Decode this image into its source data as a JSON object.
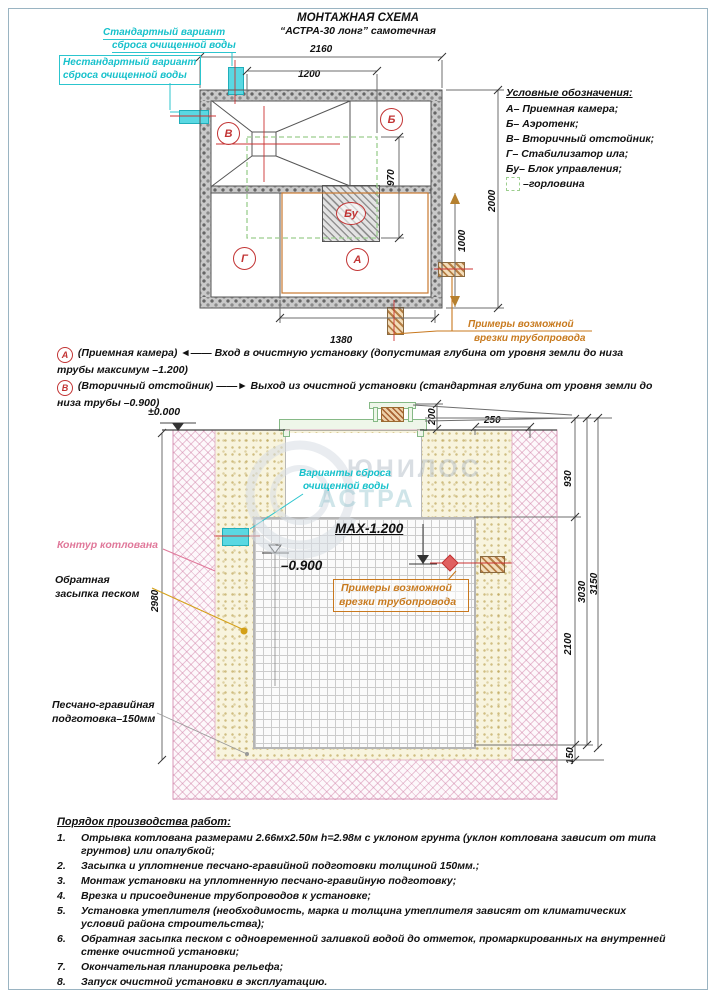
{
  "title": {
    "line1": "МОНТАЖНАЯ СХЕМА",
    "line2": "“АСТРА-30 лонг” самотечная"
  },
  "plan": {
    "standard_outlet": {
      "line1": "Стандартный вариант",
      "line2": "сброса очищенной воды"
    },
    "nonstandard_outlet": {
      "line1": "Нестандартный вариант",
      "line2": "сброса очищенной воды"
    },
    "compartments": {
      "a": "А",
      "b": "Б",
      "v": "В",
      "g": "Г",
      "bu": "Бу"
    },
    "dims": {
      "total_width": "2160",
      "neck_width": "1200",
      "neck_height": "970",
      "total_height": "2000",
      "side_offset": "1000",
      "bottom_width": "1380"
    }
  },
  "pipe_note": {
    "line1": "Примеры возможной",
    "line2": "врезки трубопровода"
  },
  "legend": {
    "title": "Условные обозначения:",
    "items": [
      "А– Приемная камера;",
      "Б– Аэротенк;",
      "В– Вторичный отстойник;",
      "Г– Стабилизатор ила;",
      "Бу– Блок управления;",
      "–горловина"
    ]
  },
  "notes": [
    {
      "marker": "А",
      "pre": "(Приемная камера)",
      "arrow": "◄——",
      "text": "Вход в очистную установку (допустимая глубина от уровня земли до низа трубы максимум –1.200)"
    },
    {
      "marker": "В",
      "pre": "(Вторичный отстойник)",
      "arrow": "——►",
      "text": "Выход из очистной установки (стандартная глубина от уровня земли до низа трубы –0.900)"
    }
  ],
  "section": {
    "zero_level": "±0.000",
    "max_label": "МАХ-1.200",
    "outlet_level": "–0.900",
    "discharge": {
      "line1": "Варианты сброса",
      "line2": "очищенной воды"
    },
    "pit_label": "Контур котлована",
    "backfill": {
      "line1": "Обратная",
      "line2": "засыпка песком"
    },
    "bed": {
      "line1": "Песчано-гравийная",
      "line2": "подготовка–150мм"
    },
    "dims": {
      "cover": "200",
      "edge_offset": "250",
      "neck_depth": "930",
      "body_height": "2100",
      "sum_depth": "3030",
      "total_depth": "3150",
      "bed_thickness": "150",
      "pit_depth": "2980"
    },
    "watermark": {
      "line1": "ЮНИЛОС",
      "line2": "АСТРА"
    }
  },
  "worklist": {
    "title": "Порядок производства работ:",
    "items": [
      {
        "n": "1.",
        "t": "Отрывка котлована размерами 2.66мх2.50м h=2.98м с уклоном грунта (уклон котлована зависит от типа грунтов) или опалубкой;"
      },
      {
        "n": "2.",
        "t": "Засыпка и уплотнение песчано-гравийной подготовки толщиной 150мм.;"
      },
      {
        "n": "3.",
        "t": "Монтаж установки на уплотненную песчано-гравийную подготовку;"
      },
      {
        "n": "4.",
        "t": "Врезка и присоединение трубопроводов к установке;"
      },
      {
        "n": "5.",
        "t": "Установка утеплителя (необходимость, марка и толщина утеплителя зависят от климатических условий района строительства);"
      },
      {
        "n": "6.",
        "t": "Обратная засыпка песком с одновременной заливкой водой до отметок, промаркированных на внутренней стенке очистной установки;"
      },
      {
        "n": "7.",
        "t": "Окончательная планировка рельефа;"
      },
      {
        "n": "8.",
        "t": "Запуск очистной установки в эксплуатацию."
      }
    ]
  }
}
